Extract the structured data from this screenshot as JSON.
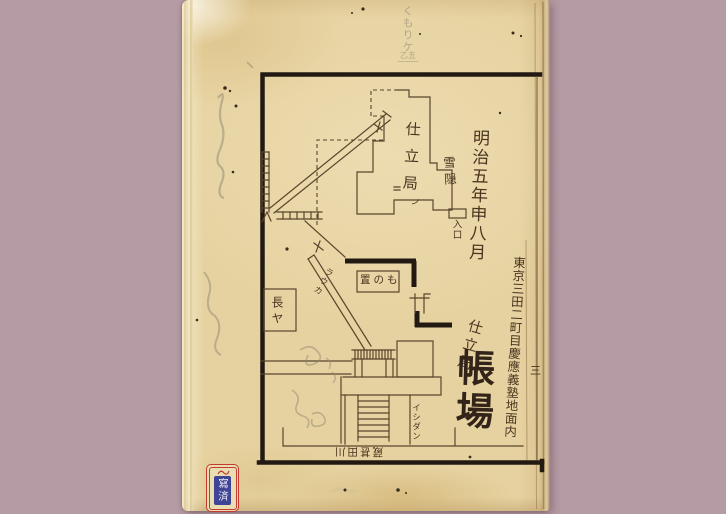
{
  "colors": {
    "backdrop": "#b59ba4",
    "paper": "#e6d2a0",
    "ink_line": "#5a452c",
    "ink_heavy": "#221a12",
    "ink_text": "#4a3420",
    "title_ink": "#33241a",
    "pencil": "#8f8874",
    "seal_red": "#c23b2e",
    "seal_blue": "#3f4496",
    "seal_text": "#f0eef2"
  },
  "pencil_notes": {
    "column": "くもりケ",
    "boxed": "乙五"
  },
  "plan": {
    "date_column": "明治五年申八月",
    "building": "仕立局",
    "building_tick": "ノ",
    "annex": "雪隠",
    "entrance": "入口",
    "storage": "置のも",
    "rowhouse": "長ヤ",
    "corridor": "ラウカ",
    "stairs": "イシダン",
    "street_rotated": "蔵甚田川"
  },
  "margin": {
    "address": "東京三田二町目慶應義塾地面内",
    "office": "仕立局",
    "title": "帳場",
    "folio": "三"
  },
  "seal": {
    "text": "寫済"
  }
}
